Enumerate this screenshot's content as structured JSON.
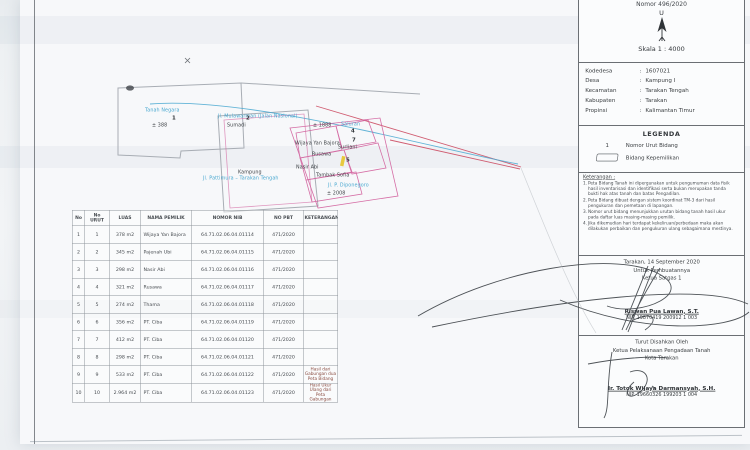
{
  "colors": {
    "parcel_pink": "#d25f9c",
    "boundary_red": "#cc4d63",
    "annotation_blue": "#49a8d0",
    "pencil_gray": "#a8adb4",
    "highlight_yellow": "#e8c93e"
  },
  "titleblock": {
    "nomor": "Nomor 496/2020",
    "north_label": "U",
    "skala": "Skala 1 : 4000",
    "info": [
      {
        "label": "Kodedesa",
        "value": "1607021"
      },
      {
        "label": "Desa",
        "value": "Kampung I"
      },
      {
        "label": "Kecamatan",
        "value": "Tarakan Tengah"
      },
      {
        "label": "Kabupaten",
        "value": "Tarakan"
      },
      {
        "label": "Propinsi",
        "value": "Kalimantan Timur"
      }
    ],
    "legend": {
      "title": "LEGENDA",
      "items": [
        {
          "symbol": "1",
          "label": "Nomor Urut Bidang"
        },
        {
          "symbol": "parcel-outline",
          "label": "Bidang Kepemilikan"
        }
      ]
    },
    "keterangan": {
      "title": "Keterangan :",
      "notes": [
        "Peta Bidang Tanah ini dipergunakan untuk pengumuman data fisik hasil inventarisasi dan identifikasi serta bukan merupakan tanda bukti hak atas tanah dan batas Pengadilan.",
        "Peta Bidang dibuat dengan sistem koordinat TM-3 dari hasil pengukuran dan pemetaan di lapangan.",
        "Nomor urut bidang menunjukkan urutan bidang tanah hasil ukur pada daftar luas masing-masing pemilik.",
        "Jika dikemudian hari terdapat kekeliruan/perbedaan maka akan dilakukan perbaikan dan pengukuran ulang sebagaimana mestinya."
      ]
    },
    "signoff_surveyor": {
      "place_date": "Tarakan, 14 September 2020",
      "for_line": "Untuk Pembuatannya",
      "role": "Ketua Satgas 1",
      "name": "Riswan Pua Lawan, S.T.",
      "nip": "NIP. 19870419 200912 1 003"
    },
    "signoff_approval": {
      "line1": "Turut Disahkan Oleh",
      "line2": "Ketua Pelaksanaan Pengadaan Tanah",
      "line3": "Kota Tarakan",
      "name": "Ir. Totok Wijaya Darmansyah, S.H.",
      "nip": "NIP. 19660326 199203 1 004"
    }
  },
  "table": {
    "headers": [
      "No",
      "No URUT",
      "LUAS",
      "NAMA PEMILIK",
      "NOMOR NIB",
      "NO PBT",
      "KETERANGAN"
    ],
    "rows": [
      {
        "no": "1",
        "urut": "1",
        "luas": "378 m2",
        "nama": "Wijaya Yan Bajora",
        "nib": "64.71.02.06.04.01114",
        "pbt": "471/2020",
        "ket": ""
      },
      {
        "no": "2",
        "urut": "2",
        "luas": "345 m2",
        "nama": "Pajenah Ubi",
        "nib": "64.71.02.06.04.01115",
        "pbt": "471/2020",
        "ket": ""
      },
      {
        "no": "3",
        "urut": "3",
        "luas": "298 m2",
        "nama": "Nasir Abi",
        "nib": "64.71.02.06.04.01116",
        "pbt": "471/2020",
        "ket": ""
      },
      {
        "no": "4",
        "urut": "4",
        "luas": "321 m2",
        "nama": "Rusawa",
        "nib": "64.71.02.06.04.01117",
        "pbt": "471/2020",
        "ket": ""
      },
      {
        "no": "5",
        "urut": "5",
        "luas": "274 m2",
        "nama": "Thama",
        "nib": "64.71.02.06.04.01118",
        "pbt": "471/2020",
        "ket": ""
      },
      {
        "no": "6",
        "urut": "6",
        "luas": "356 m2",
        "nama": "PT. Ciba",
        "nib": "64.71.02.06.04.01119",
        "pbt": "471/2020",
        "ket": ""
      },
      {
        "no": "7",
        "urut": "7",
        "luas": "412 m2",
        "nama": "PT. Ciba",
        "nib": "64.71.02.06.04.01120",
        "pbt": "471/2020",
        "ket": ""
      },
      {
        "no": "8",
        "urut": "8",
        "luas": "298 m2",
        "nama": "PT. Ciba",
        "nib": "64.71.02.06.04.01121",
        "pbt": "471/2020",
        "ket": ""
      },
      {
        "no": "9",
        "urut": "9",
        "luas": "533 m2",
        "nama": "PT. Ciba",
        "nib": "64.71.02.06.04.01122",
        "pbt": "471/2020",
        "ket": "Hasil dari Gabungan dua Peta Bidang"
      },
      {
        "no": "10",
        "urut": "10",
        "luas": "2.964 m2",
        "nama": "PT. Ciba",
        "nib": "64.71.02.06.04.01123",
        "pbt": "471/2020",
        "ket": "Hasil Ukur Ulang dari Peta Gabungan"
      }
    ]
  },
  "map": {
    "labels": [
      {
        "text": "Tanah Negara",
        "x": 45,
        "y": 56,
        "cls": "ml-blue"
      },
      {
        "text": "1",
        "x": 72,
        "y": 64,
        "cls": "ml-num"
      },
      {
        "text": "± 388",
        "x": 52,
        "y": 71,
        "cls": "ml-black"
      },
      {
        "text": "Jl. Mulawarman (Jalan Nasional)",
        "x": 118,
        "y": 62,
        "cls": "ml-blue"
      },
      {
        "text": "Sumadi",
        "x": 127,
        "y": 71,
        "cls": "ml-black"
      },
      {
        "text": "2",
        "x": 146,
        "y": 64,
        "cls": "ml-num"
      },
      {
        "text": "Wijaya Yan Bajora",
        "x": 195,
        "y": 89,
        "cls": "ml-black"
      },
      {
        "text": "4",
        "x": 251,
        "y": 77,
        "cls": "ml-num"
      },
      {
        "text": "Rusawa",
        "x": 212,
        "y": 100,
        "cls": "ml-black"
      },
      {
        "text": "Surliani",
        "x": 238,
        "y": 93,
        "cls": "ml-black"
      },
      {
        "text": "7",
        "x": 252,
        "y": 86,
        "cls": "ml-num"
      },
      {
        "text": "Nasir Abi",
        "x": 196,
        "y": 113,
        "cls": "ml-black"
      },
      {
        "text": "5",
        "x": 246,
        "y": 106,
        "cls": "ml-num"
      },
      {
        "text": "Tambak Sofia",
        "x": 216,
        "y": 121,
        "cls": "ml-black"
      },
      {
        "text": "± 1888",
        "x": 213,
        "y": 71,
        "cls": "ml-black"
      },
      {
        "text": "Saluran",
        "x": 241,
        "y": 70,
        "cls": "ml-blue"
      },
      {
        "text": "Jl. P. Diponegoro",
        "x": 228,
        "y": 131,
        "cls": "ml-blue"
      },
      {
        "text": "± 2008",
        "x": 227,
        "y": 139,
        "cls": "ml-black"
      },
      {
        "text": "Kampung",
        "x": 138,
        "y": 118,
        "cls": "ml-black"
      },
      {
        "text": "Jl. Pattimura – Tarakan Tengah",
        "x": 103,
        "y": 124,
        "cls": "ml-blue"
      }
    ]
  }
}
